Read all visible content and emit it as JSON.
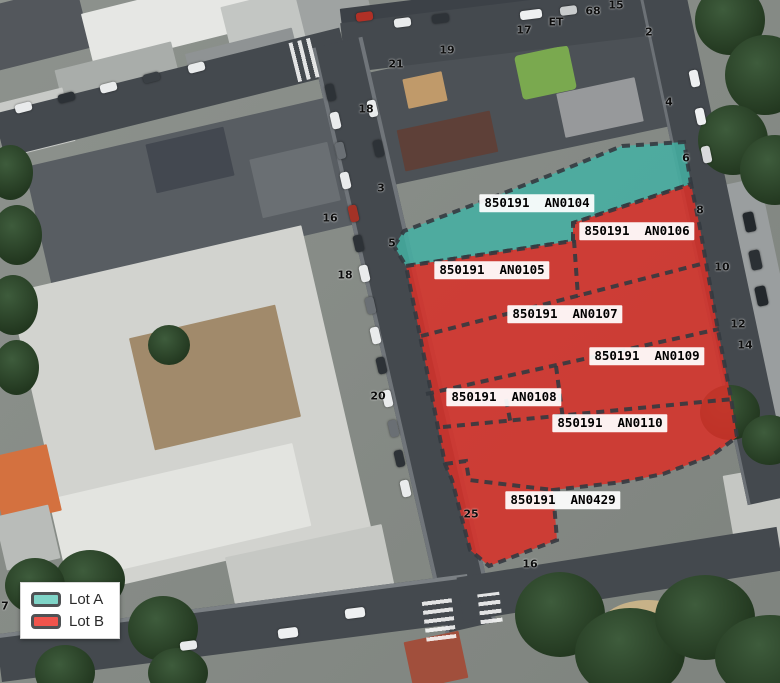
{
  "legend": {
    "items": [
      {
        "label": "Lot A",
        "color": "#7fd4c7"
      },
      {
        "label": "Lot B",
        "color": "#f0544c"
      }
    ]
  },
  "parcels": [
    {
      "label": "850191  AN0104",
      "lot": "A"
    },
    {
      "label": "850191  AN0106",
      "lot": "B"
    },
    {
      "label": "850191  AN0105",
      "lot": "B"
    },
    {
      "label": "850191  AN0107",
      "lot": "B"
    },
    {
      "label": "850191  AN0109",
      "lot": "B"
    },
    {
      "label": "850191  AN0108",
      "lot": "B"
    },
    {
      "label": "850191  AN0110",
      "lot": "B"
    },
    {
      "label": "850191  AN0429",
      "lot": "B"
    }
  ],
  "street_numbers": [
    {
      "text": "21"
    },
    {
      "text": "19"
    },
    {
      "text": "17"
    },
    {
      "text": "ET"
    },
    {
      "text": "68"
    },
    {
      "text": "15"
    },
    {
      "text": "2"
    },
    {
      "text": "18"
    },
    {
      "text": "3"
    },
    {
      "text": "16"
    },
    {
      "text": "5"
    },
    {
      "text": "18"
    },
    {
      "text": "20"
    },
    {
      "text": "4"
    },
    {
      "text": "6"
    },
    {
      "text": "8"
    },
    {
      "text": "10"
    },
    {
      "text": "12"
    },
    {
      "text": "14"
    },
    {
      "text": "25"
    },
    {
      "text": "16"
    },
    {
      "text": "7"
    }
  ],
  "overlay_colors": {
    "lot_a_fill": "#44b0a3",
    "lot_b_fill": "#d93129",
    "boundary": "#343a40"
  }
}
